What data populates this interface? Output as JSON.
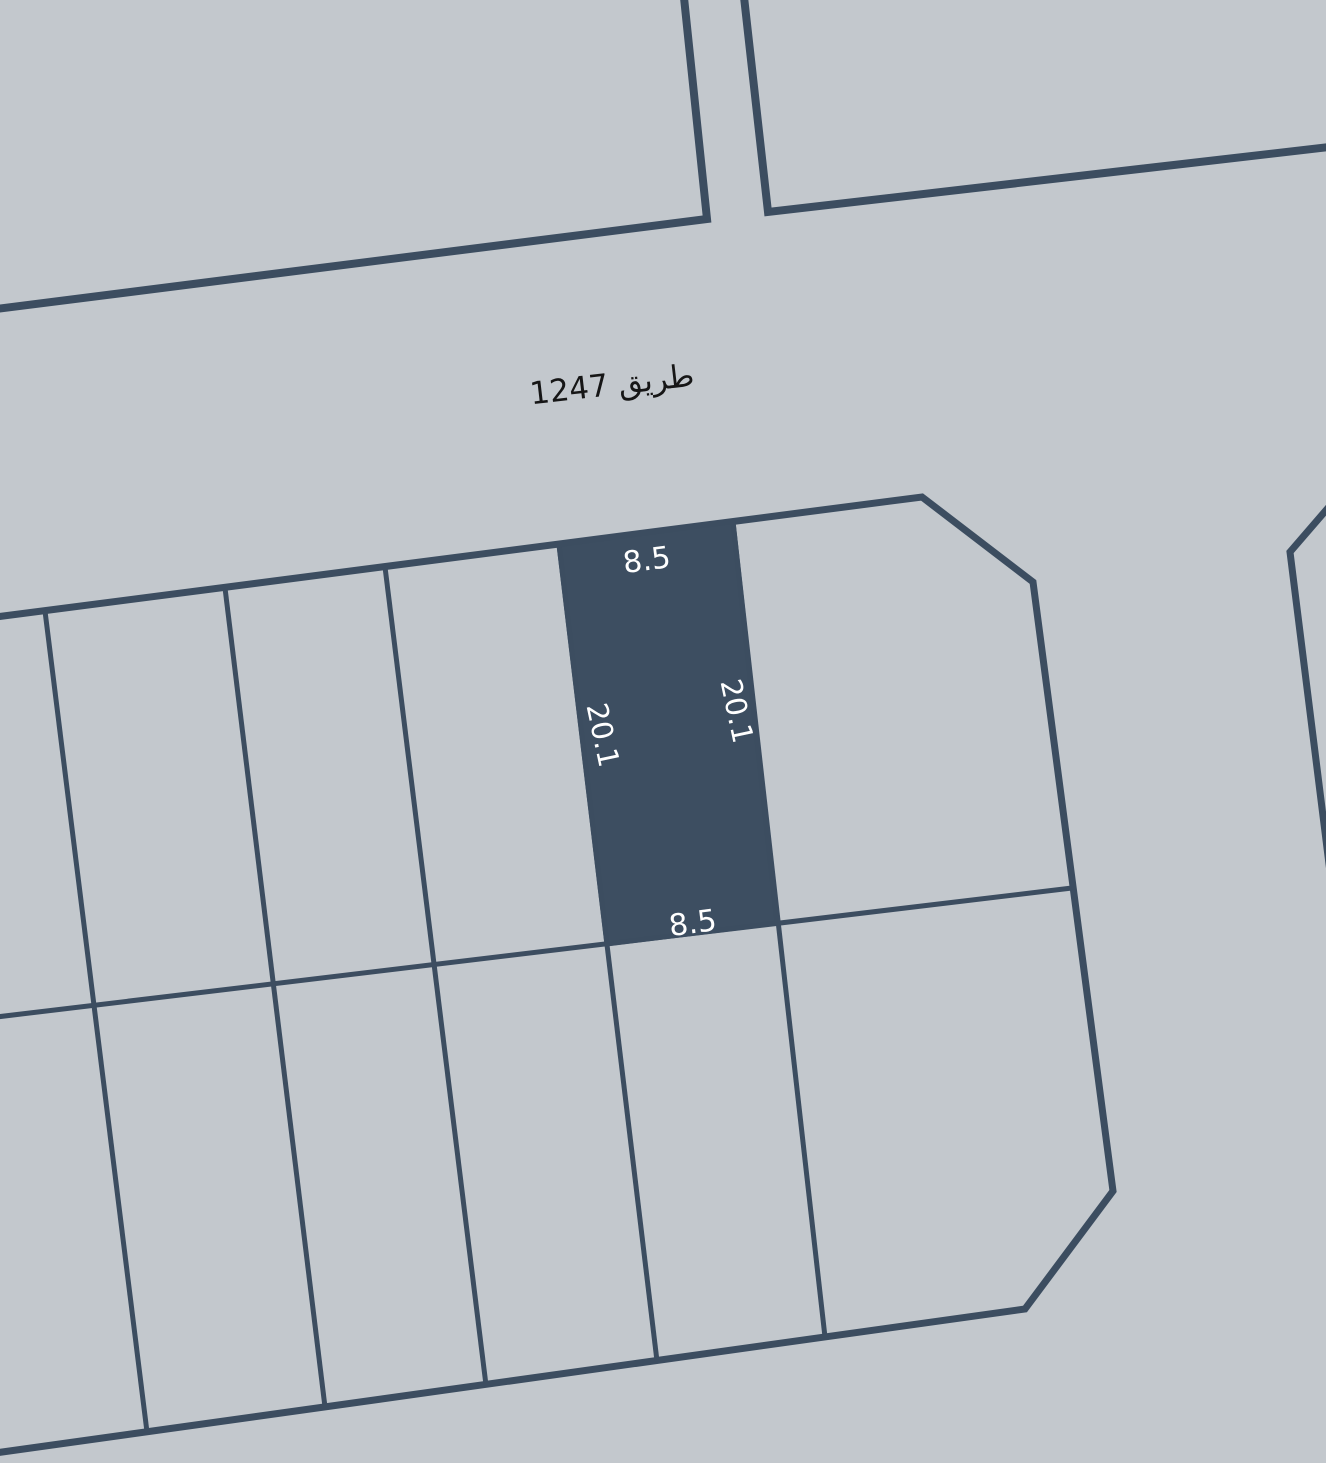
{
  "map": {
    "background_color": "#c3c8cd",
    "line_color": "#3c4d60",
    "road_label": {
      "text": "طريق 1247",
      "text_color": "#161616"
    },
    "selected_parcel": {
      "fill_color": "#3d4e61",
      "dimension_text_color": "#ffffff",
      "dimensions": {
        "top_width": "8.5",
        "right_length": "20.1",
        "bottom_width": "8.5",
        "left_length": "20.1"
      }
    }
  }
}
